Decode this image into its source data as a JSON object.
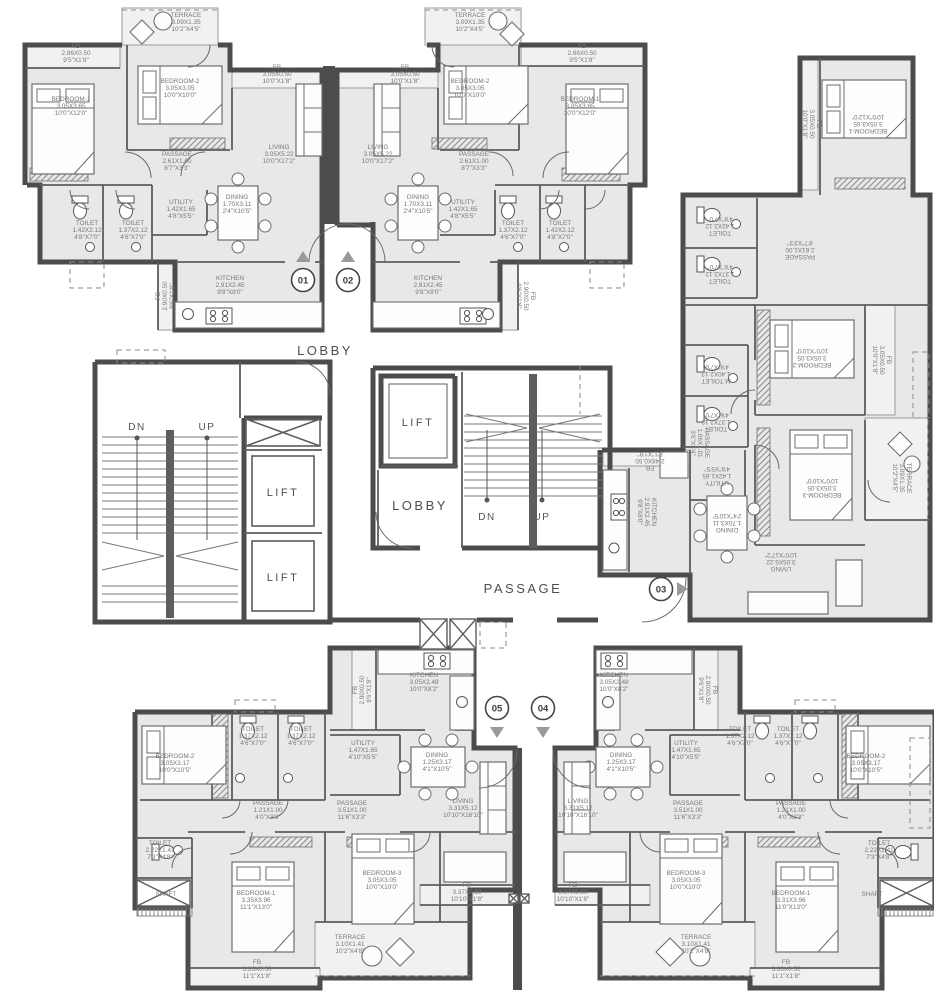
{
  "drawing": {
    "type": "residential-tower-typical-floor-plan",
    "units_on_floor": [
      "01",
      "02",
      "03",
      "04",
      "05"
    ]
  },
  "colors": {
    "wall": "#4c4c4c",
    "inner_wall": "#5d5d5d",
    "floor_fill": "#e8e8e8",
    "terrace_fill": "#f1f1f1",
    "label_text": "#787878",
    "big_text": "#4e4e4e",
    "arrow_fill": "#9a9a9a"
  },
  "room_labels": [
    {
      "unit": "01",
      "name": "TERRACE",
      "m": "3.09X1.35",
      "ft": "10'2\"X4'5\"",
      "x": 186,
      "y": 24,
      "r": 0
    },
    {
      "unit": "01",
      "name": "FB",
      "m": "2.86X0.50",
      "ft": "9'5\"X1'8\"",
      "x": 76,
      "y": 55,
      "r": 0
    },
    {
      "unit": "01",
      "name": "BEDROOM-1",
      "m": "3.05X3.65",
      "ft": "10'0\"X12'0\"",
      "x": 71,
      "y": 108,
      "r": 0
    },
    {
      "unit": "01",
      "name": "BEDROOM-2",
      "m": "3.05X3.05",
      "ft": "10'0\"X10'0\"",
      "x": 180,
      "y": 90,
      "r": 0
    },
    {
      "unit": "01",
      "name": "FB",
      "m": "3.05X0.50",
      "ft": "10'0\"X1'8\"",
      "x": 277,
      "y": 76,
      "r": 0
    },
    {
      "unit": "01",
      "name": "LIVING",
      "m": "3.05X5.22",
      "ft": "10'0\"X17'2\"",
      "x": 279,
      "y": 156,
      "r": 0
    },
    {
      "unit": "01",
      "name": "PASSAGE",
      "m": "2.61X1.00",
      "ft": "8'7\"X3'3\"",
      "x": 177,
      "y": 163,
      "r": 0
    },
    {
      "unit": "01",
      "name": "DINING",
      "m": "1.70X3.11",
      "ft": "2'4\"X10'5\"",
      "x": 237,
      "y": 206,
      "r": 0
    },
    {
      "unit": "01",
      "name": "UTILITY",
      "m": "1.42X1.65",
      "ft": "4'8\"X5'5\"",
      "x": 181,
      "y": 211,
      "r": 0
    },
    {
      "unit": "01",
      "name": "TOILET",
      "m": "1.42X2.12",
      "ft": "4'8\"X7'0\"",
      "x": 87,
      "y": 232,
      "r": 0
    },
    {
      "unit": "01",
      "name": "TOILET",
      "m": "1.37X2.12",
      "ft": "4'6\"X7'0\"",
      "x": 133,
      "y": 232,
      "r": 0
    },
    {
      "unit": "01",
      "name": "KITCHEN",
      "m": "2.91X2.45",
      "ft": "9'8\"X8'0\"",
      "x": 230,
      "y": 287,
      "r": 0
    },
    {
      "unit": "01",
      "name": "FB",
      "m": "2.90X0.50",
      "ft": "9'6\"X1'8\"",
      "x": 167,
      "y": 296,
      "r": -90
    },
    {
      "unit": "02",
      "name": "TERRACE",
      "m": "3.09X1.35",
      "ft": "10'2\"X4'5\"",
      "x": 470,
      "y": 24,
      "r": 0
    },
    {
      "unit": "02",
      "name": "FB",
      "m": "2.86X0.50",
      "ft": "9'5\"X1'8\"",
      "x": 582,
      "y": 55,
      "r": 0
    },
    {
      "unit": "02",
      "name": "BEDROOM-1",
      "m": "3.05X3.65",
      "ft": "10'0\"X12'0\"",
      "x": 580,
      "y": 108,
      "r": 0
    },
    {
      "unit": "02",
      "name": "BEDROOM-2",
      "m": "3.05X3.05",
      "ft": "10'0\"X10'0\"",
      "x": 470,
      "y": 90,
      "r": 0
    },
    {
      "unit": "02",
      "name": "FB",
      "m": "3.05X0.50",
      "ft": "10'0\"X1'8\"",
      "x": 405,
      "y": 76,
      "r": 0
    },
    {
      "unit": "02",
      "name": "LIVING",
      "m": "3.05X5.22",
      "ft": "10'0\"X17'2\"",
      "x": 378,
      "y": 156,
      "r": 0
    },
    {
      "unit": "02",
      "name": "PASSAGE",
      "m": "2.61X1.00",
      "ft": "8'7\"X3'3\"",
      "x": 474,
      "y": 163,
      "r": 0
    },
    {
      "unit": "02",
      "name": "DINING",
      "m": "1.70X3.11",
      "ft": "2'4\"X10'5\"",
      "x": 418,
      "y": 206,
      "r": 0
    },
    {
      "unit": "02",
      "name": "UTILITY",
      "m": "1.42X1.65",
      "ft": "4'8\"X5'5\"",
      "x": 463,
      "y": 211,
      "r": 0
    },
    {
      "unit": "02",
      "name": "TOILET",
      "m": "1.37X2.12",
      "ft": "4'6\"X7'0\"",
      "x": 513,
      "y": 232,
      "r": 0
    },
    {
      "unit": "02",
      "name": "TOILET",
      "m": "1.42X2.12",
      "ft": "4'8\"X7'0\"",
      "x": 560,
      "y": 232,
      "r": 0
    },
    {
      "unit": "02",
      "name": "KITCHEN",
      "m": "2.91X2.45",
      "ft": "9'8\"X8'0\"",
      "x": 428,
      "y": 287,
      "r": 0
    },
    {
      "unit": "02",
      "name": "FB",
      "m": "2.90X0.50",
      "ft": "9'6\"X1'8\"",
      "x": 524,
      "y": 296,
      "r": 90
    },
    {
      "unit": "03",
      "name": "BEDROOM-1",
      "m": "3.05X3.65",
      "ft": "10'0\"X12'0\"",
      "x": 868,
      "y": 122,
      "r": 180
    },
    {
      "unit": "03",
      "name": "FB",
      "m": "3.05X0.50",
      "ft": "10'0\"X1'8\"",
      "x": 810,
      "y": 124,
      "r": 90
    },
    {
      "unit": "03",
      "name": "PASSAGE",
      "m": "2.61X1.00",
      "ft": "8'7\"X3'3\"",
      "x": 800,
      "y": 248,
      "r": 180
    },
    {
      "unit": "03",
      "name": "TOILET",
      "m": "1.42X2.12",
      "ft": "4'8\"X7'0\"",
      "x": 720,
      "y": 224,
      "r": 180
    },
    {
      "unit": "03",
      "name": "TOILET",
      "m": "1.37X2.12",
      "ft": "4'6\"X7'0\"",
      "x": 720,
      "y": 272,
      "r": 180
    },
    {
      "unit": "03",
      "name": "BEDROOM-2",
      "m": "3.05X3.05",
      "ft": "10'0\"X10'0\"",
      "x": 812,
      "y": 356,
      "r": 180
    },
    {
      "unit": "03",
      "name": "FB",
      "m": "3.05X0.50",
      "ft": "10'0\"X1'8\"",
      "x": 880,
      "y": 360,
      "r": 90
    },
    {
      "unit": "03",
      "name": "M.TOILET",
      "m": "1.40X2.13",
      "ft": "4'8\"X7'0\"",
      "x": 716,
      "y": 372,
      "r": 180
    },
    {
      "unit": "03",
      "name": "TOILET",
      "m": "1.37X2.12",
      "ft": "4'6\"X7'0\"",
      "x": 716,
      "y": 420,
      "r": 180
    },
    {
      "unit": "03",
      "name": "PASSAGE",
      "m": "1.06X1.01",
      "ft": "3'6\"X3'4\"",
      "x": 698,
      "y": 443,
      "r": 90
    },
    {
      "unit": "03",
      "name": "UTILITY",
      "m": "1.42X1.65",
      "ft": "4'8\"X5'5\"",
      "x": 717,
      "y": 474,
      "r": 180
    },
    {
      "unit": "03",
      "name": "KITCHEN",
      "m": "2.91X2.45",
      "ft": "9'8\"X8'0\"",
      "x": 645,
      "y": 512,
      "r": 90
    },
    {
      "unit": "03",
      "name": "FB",
      "m": "2.48X0.50",
      "ft": "8'1\"X1'8\"",
      "x": 650,
      "y": 459,
      "r": 180
    },
    {
      "unit": "03",
      "name": "DINING",
      "m": "1.70X3.11",
      "ft": "2'4\"X10'5\"",
      "x": 727,
      "y": 521,
      "r": 180
    },
    {
      "unit": "03",
      "name": "LIVING",
      "m": "3.05X5.22",
      "ft": "10'0\"X17'2\"",
      "x": 781,
      "y": 560,
      "r": 180
    },
    {
      "unit": "03",
      "name": "BEDROOM-3",
      "m": "3.05X3.05",
      "ft": "10'0\"X10'0\"",
      "x": 822,
      "y": 486,
      "r": 180
    },
    {
      "unit": "03",
      "name": "TERRACE",
      "m": "3.09X1.35",
      "ft": "10'2\"X4'5\"",
      "x": 900,
      "y": 478,
      "r": 90
    },
    {
      "unit": "05",
      "name": "BEDROOM-2",
      "m": "3.05X3.17",
      "ft": "10'0\"X10'5\"",
      "x": 175,
      "y": 765,
      "r": 0
    },
    {
      "unit": "05",
      "name": "TOILET",
      "m": "1.37X2.12",
      "ft": "4'6\"X7'0\"",
      "x": 253,
      "y": 738,
      "r": 0
    },
    {
      "unit": "05",
      "name": "TOILET",
      "m": "1.37X2.12",
      "ft": "4'6\"X7'0\"",
      "x": 301,
      "y": 738,
      "r": 0
    },
    {
      "unit": "05",
      "name": "UTILITY",
      "m": "1.47X1.65",
      "ft": "4'10\"X5'5\"",
      "x": 363,
      "y": 752,
      "r": 0
    },
    {
      "unit": "05",
      "name": "KITCHEN",
      "m": "3.05X2.48",
      "ft": "10'0\"X8'2\"",
      "x": 424,
      "y": 684,
      "r": 0
    },
    {
      "unit": "05",
      "name": "FB",
      "m": "2.90X0.50",
      "ft": "9'6\"X1'8\"",
      "x": 364,
      "y": 690,
      "r": -90
    },
    {
      "unit": "05",
      "name": "DINING",
      "m": "1.25X3.17",
      "ft": "4'1\"X10'5\"",
      "x": 437,
      "y": 764,
      "r": 0
    },
    {
      "unit": "05",
      "name": "PASSAGE",
      "m": "1.21X1.00",
      "ft": "4'0\"X3'3\"",
      "x": 268,
      "y": 812,
      "r": 0
    },
    {
      "unit": "05",
      "name": "PASSAGE",
      "m": "3.51X1.00",
      "ft": "11'6\"X3'3\"",
      "x": 352,
      "y": 812,
      "r": 0
    },
    {
      "unit": "05",
      "name": "LIVING",
      "m": "3.31X5.12",
      "ft": "10'10\"X16'10\"",
      "x": 463,
      "y": 810,
      "r": 0
    },
    {
      "unit": "05",
      "name": "FB",
      "m": "3.37X0.50",
      "ft": "10'10\"X1'8\"",
      "x": 467,
      "y": 894,
      "r": 0
    },
    {
      "unit": "05",
      "name": "TOILET",
      "m": "2.22X1.41",
      "ft": "7'3\"X4'8\"",
      "x": 160,
      "y": 852,
      "r": 0
    },
    {
      "unit": "05",
      "name": "SHAFT",
      "m": "",
      "ft": "",
      "x": 166,
      "y": 896,
      "r": 0
    },
    {
      "unit": "05",
      "name": "BEDROOM-1",
      "m": "3.35X3.96",
      "ft": "11'1\"X13'0\"",
      "x": 256,
      "y": 902,
      "r": 0
    },
    {
      "unit": "05",
      "name": "BEDROOM-3",
      "m": "3.05X3.05",
      "ft": "10'0\"X10'0\"",
      "x": 382,
      "y": 882,
      "r": 0
    },
    {
      "unit": "05",
      "name": "TERRACE",
      "m": "3.10X1.41",
      "ft": "10'2\"X4'8\"",
      "x": 350,
      "y": 946,
      "r": 0
    },
    {
      "unit": "05",
      "name": "FB",
      "m": "3.36X0.50",
      "ft": "11'1\"X1'8\"",
      "x": 257,
      "y": 971,
      "r": 0
    },
    {
      "unit": "04",
      "name": "KITCHEN",
      "m": "3.05X2.48",
      "ft": "10'0\"X8'2\"",
      "x": 614,
      "y": 684,
      "r": 0
    },
    {
      "unit": "04",
      "name": "FB",
      "m": "2.90X0.50",
      "ft": "9'6\"X1'8\"",
      "x": 706,
      "y": 690,
      "r": 90
    },
    {
      "unit": "04",
      "name": "UTILITY",
      "m": "1.47X1.65",
      "ft": "4'10\"X5'5\"",
      "x": 686,
      "y": 752,
      "r": 0
    },
    {
      "unit": "04",
      "name": "TOILET",
      "m": "1.37X2.12",
      "ft": "4'6\"X7'0\"",
      "x": 740,
      "y": 738,
      "r": 0
    },
    {
      "unit": "04",
      "name": "TOILET",
      "m": "1.37X2.12",
      "ft": "4'6\"X7'0\"",
      "x": 788,
      "y": 738,
      "r": 0
    },
    {
      "unit": "04",
      "name": "BEDROOM-2",
      "m": "3.05X3.17",
      "ft": "10'0\"X10'5\"",
      "x": 866,
      "y": 765,
      "r": 0
    },
    {
      "unit": "04",
      "name": "DINING",
      "m": "1.25X3.17",
      "ft": "4'1\"X10'5\"",
      "x": 621,
      "y": 764,
      "r": 0
    },
    {
      "unit": "04",
      "name": "PASSAGE",
      "m": "3.51X1.00",
      "ft": "11'6\"X3'3\"",
      "x": 688,
      "y": 812,
      "r": 0
    },
    {
      "unit": "04",
      "name": "PASSAGE",
      "m": "1.21X1.00",
      "ft": "4'0\"X3'3\"",
      "x": 791,
      "y": 812,
      "r": 0
    },
    {
      "unit": "04",
      "name": "LIVING",
      "m": "3.31X5.12",
      "ft": "10'10\"X16'10\"",
      "x": 578,
      "y": 810,
      "r": 0
    },
    {
      "unit": "04",
      "name": "FB",
      "m": "3.37X0.50",
      "ft": "10'10\"X1'8\"",
      "x": 573,
      "y": 894,
      "r": 0
    },
    {
      "unit": "04",
      "name": "TOILET",
      "m": "2.22X1.41",
      "ft": "7'3\"X4'8\"",
      "x": 879,
      "y": 852,
      "r": 0
    },
    {
      "unit": "04",
      "name": "SHAFT",
      "m": "",
      "ft": "",
      "x": 872,
      "y": 896,
      "r": 0
    },
    {
      "unit": "04",
      "name": "BEDROOM-3",
      "m": "3.05X3.05",
      "ft": "10'0\"X10'0\"",
      "x": 686,
      "y": 882,
      "r": 0
    },
    {
      "unit": "04",
      "name": "BEDROOM-1",
      "m": "3.31X3.96",
      "ft": "11'0\"X13'0\"",
      "x": 791,
      "y": 902,
      "r": 0
    },
    {
      "unit": "04",
      "name": "TERRACE",
      "m": "3.10X1.41",
      "ft": "10'2\"X4'8\"",
      "x": 696,
      "y": 946,
      "r": 0
    },
    {
      "unit": "04",
      "name": "FB",
      "m": "3.36X0.50",
      "ft": "11'1\"X1'8\"",
      "x": 786,
      "y": 971,
      "r": 0
    }
  ],
  "core_labels": [
    {
      "text": "LOBBY",
      "x": 325,
      "y": 355,
      "size": 13
    },
    {
      "text": "LIFT",
      "x": 283,
      "y": 496,
      "size": 11
    },
    {
      "text": "LIFT",
      "x": 283,
      "y": 581,
      "size": 11
    },
    {
      "text": "LIFT",
      "x": 418,
      "y": 426,
      "size": 11
    },
    {
      "text": "LOBBY",
      "x": 420,
      "y": 510,
      "size": 13
    },
    {
      "text": "PASSAGE",
      "x": 523,
      "y": 593,
      "size": 13
    }
  ],
  "stair_labels": [
    {
      "text": "DN",
      "x": 137,
      "y": 430
    },
    {
      "text": "UP",
      "x": 207,
      "y": 430
    },
    {
      "text": "DN",
      "x": 487,
      "y": 520
    },
    {
      "text": "UP",
      "x": 542,
      "y": 520
    }
  ],
  "unit_markers": [
    {
      "label": "01",
      "cx": 303,
      "cy": 280,
      "ax": 303,
      "ay": 258,
      "dir": "up"
    },
    {
      "label": "02",
      "cx": 348,
      "cy": 280,
      "ax": 348,
      "ay": 258,
      "dir": "up"
    },
    {
      "label": "03",
      "cx": 661,
      "cy": 589,
      "ax": 681,
      "ay": 589,
      "dir": "right"
    },
    {
      "label": "05",
      "cx": 497,
      "cy": 708,
      "ax": 497,
      "ay": 731,
      "dir": "down"
    },
    {
      "label": "04",
      "cx": 543,
      "cy": 708,
      "ax": 543,
      "ay": 731,
      "dir": "down"
    }
  ]
}
